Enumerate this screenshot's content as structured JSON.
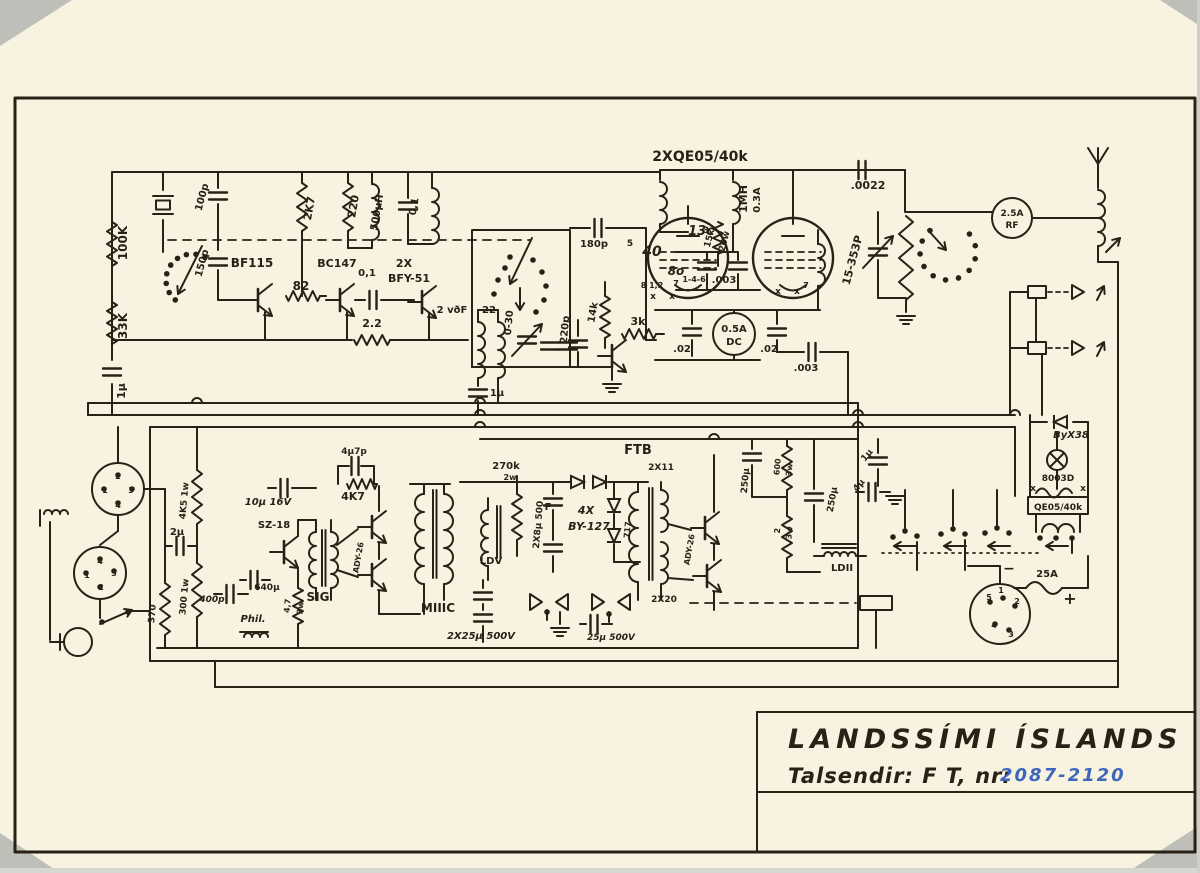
{
  "title_block": {
    "organization": "LANDSSÍMI ÍSLANDS",
    "device_label": "Talsendir: F T, nr:",
    "serial_numbers": "2087-2120"
  },
  "colors": {
    "paper": "#f8f3e1",
    "ink": "#2a2116",
    "blue_ink": "#3f66bd",
    "scan_gray": "#bfbfba"
  },
  "labels": [
    {
      "id": "r-100k",
      "t": "100K",
      "x": 127,
      "y": 243,
      "r": -90,
      "s": 12
    },
    {
      "id": "r-33k",
      "t": "33K",
      "x": 127,
      "y": 326,
      "r": -90,
      "s": 12
    },
    {
      "id": "c-1u-left",
      "t": "1μ",
      "x": 125,
      "y": 391,
      "r": -90,
      "s": 11
    },
    {
      "id": "c-100p",
      "t": "100p",
      "x": 205,
      "y": 198,
      "r": -75,
      "s": 10
    },
    {
      "id": "c-150p",
      "t": "150p",
      "x": 205,
      "y": 264,
      "r": -75,
      "s": 10
    },
    {
      "id": "q-bf115",
      "t": "BF115",
      "x": 252,
      "y": 267,
      "s": 12
    },
    {
      "id": "r-82",
      "t": "82",
      "x": 301,
      "y": 290,
      "s": 12
    },
    {
      "id": "q-bc147",
      "t": "BC147",
      "x": 337,
      "y": 267,
      "s": 11
    },
    {
      "id": "r-2k7",
      "t": "2K7",
      "x": 313,
      "y": 209,
      "r": -80,
      "s": 11
    },
    {
      "id": "r-220",
      "t": "220",
      "x": 357,
      "y": 207,
      "r": -80,
      "s": 11
    },
    {
      "id": "l-500uh",
      "t": "500μH",
      "x": 380,
      "y": 213,
      "r": -80,
      "s": 10
    },
    {
      "id": "c-01-tank",
      "t": "0,1",
      "x": 417,
      "y": 207,
      "r": -80,
      "s": 10
    },
    {
      "id": "c-01-coupling",
      "t": "0,1",
      "x": 367,
      "y": 276,
      "s": 10
    },
    {
      "id": "q-2x",
      "t": "2X",
      "x": 404,
      "y": 267,
      "s": 11
    },
    {
      "id": "q-bfy51",
      "t": "BFY-51",
      "x": 409,
      "y": 282,
      "s": 11
    },
    {
      "id": "r-22",
      "t": "2.2",
      "x": 372,
      "y": 327,
      "s": 11
    },
    {
      "id": "l-2vdf",
      "t": "2 vðF",
      "x": 452,
      "y": 313,
      "s": 10
    },
    {
      "id": "l-22b",
      "t": "22",
      "x": 489,
      "y": 313,
      "s": 10
    },
    {
      "id": "c-030",
      "t": "0-30",
      "x": 512,
      "y": 323,
      "r": -85,
      "s": 10
    },
    {
      "id": "c-180p",
      "t": "180p",
      "x": 594,
      "y": 247,
      "s": 10
    },
    {
      "id": "c-220p",
      "t": "220p",
      "x": 568,
      "y": 330,
      "r": -85,
      "s": 10
    },
    {
      "id": "r-14k",
      "t": "14k",
      "x": 596,
      "y": 313,
      "r": -80,
      "s": 10
    },
    {
      "id": "r-3k",
      "t": "3k",
      "x": 638,
      "y": 325,
      "s": 11
    },
    {
      "id": "c-1u-mid",
      "t": "1μ",
      "x": 497,
      "y": 396,
      "s": 10
    },
    {
      "id": "l-tubes",
      "t": "2XQE05/40k",
      "x": 700,
      "y": 161,
      "s": 14,
      "b": 1
    },
    {
      "id": "l-1mh",
      "t": "1MH",
      "x": 747,
      "y": 199,
      "r": -90,
      "s": 11
    },
    {
      "id": "l-03a",
      "t": "0.3A",
      "x": 760,
      "y": 200,
      "r": -90,
      "s": 10
    },
    {
      "id": "r-15k",
      "t": "15k",
      "x": 712,
      "y": 239,
      "r": -75,
      "s": 9
    },
    {
      "id": "r-20w",
      "t": "20w",
      "x": 727,
      "y": 242,
      "r": -75,
      "s": 9
    },
    {
      "id": "b-13c",
      "t": "13c",
      "x": 701,
      "y": 235,
      "s": 13,
      "c": "blue",
      "i": 1
    },
    {
      "id": "b-40",
      "t": "40",
      "x": 652,
      "y": 256,
      "s": 14,
      "c": "blue",
      "i": 1
    },
    {
      "id": "b-8o",
      "t": "8o",
      "x": 676,
      "y": 275,
      "s": 12,
      "c": "blue",
      "i": 1
    },
    {
      "id": "pin-5",
      "t": "5",
      "x": 630,
      "y": 246,
      "s": 9
    },
    {
      "id": "pin-3",
      "t": "3",
      "x": 706,
      "y": 233,
      "s": 9
    },
    {
      "id": "pin-812",
      "t": "8 1,2",
      "x": 652,
      "y": 288,
      "s": 8
    },
    {
      "id": "pin-7",
      "t": "7",
      "x": 676,
      "y": 286,
      "s": 8
    },
    {
      "id": "pin-x1",
      "t": "x",
      "x": 653,
      "y": 299,
      "s": 9
    },
    {
      "id": "pin-x2",
      "t": "x",
      "x": 672,
      "y": 299,
      "s": 9
    },
    {
      "id": "l-146",
      "t": "1-4-6",
      "x": 694,
      "y": 282,
      "s": 8
    },
    {
      "id": "c-003a",
      "t": ".003",
      "x": 724,
      "y": 283,
      "s": 10
    },
    {
      "id": "pin-x3",
      "t": "x",
      "x": 778,
      "y": 294,
      "s": 9
    },
    {
      "id": "pin-x4",
      "t": "x",
      "x": 797,
      "y": 294,
      "s": 9
    },
    {
      "id": "pin-7b",
      "t": "7",
      "x": 806,
      "y": 288,
      "s": 8
    },
    {
      "id": "c-02a",
      "t": ".02",
      "x": 682,
      "y": 352,
      "s": 10
    },
    {
      "id": "m-05a",
      "t": "0.5A",
      "x": 734,
      "y": 332,
      "s": 10,
      "b": 1
    },
    {
      "id": "m-dc",
      "t": "DC",
      "x": 734,
      "y": 345,
      "s": 10,
      "b": 1
    },
    {
      "id": "c-02b",
      "t": ".02",
      "x": 769,
      "y": 352,
      "s": 10
    },
    {
      "id": "c-003b",
      "t": ".003",
      "x": 806,
      "y": 371,
      "s": 10
    },
    {
      "id": "c-0022",
      "t": ".0022",
      "x": 868,
      "y": 189,
      "s": 11
    },
    {
      "id": "c-15353",
      "t": "15-353P",
      "x": 856,
      "y": 261,
      "r": -75,
      "s": 11
    },
    {
      "id": "m-25a",
      "t": "2.5A",
      "x": 1012,
      "y": 216,
      "s": 9,
      "b": 1
    },
    {
      "id": "m-rf",
      "t": "RF",
      "x": 1012,
      "y": 228,
      "s": 9,
      "b": 1
    },
    {
      "id": "d-byx38",
      "t": "ByX38",
      "x": 1071,
      "y": 438,
      "s": 10,
      "i": 1
    },
    {
      "id": "l-8003d",
      "t": "8003D",
      "x": 1058,
      "y": 481,
      "s": 9
    },
    {
      "id": "l-qe05",
      "t": "QE05/40k",
      "x": 1058,
      "y": 510,
      "s": 9
    },
    {
      "id": "x-a",
      "t": "x",
      "x": 1033,
      "y": 491,
      "s": 9
    },
    {
      "id": "x-b",
      "t": "x",
      "x": 1083,
      "y": 491,
      "s": 9
    },
    {
      "id": "s1-2",
      "t": "2",
      "x": 118,
      "y": 479,
      "s": 8
    },
    {
      "id": "s1-1",
      "t": "1",
      "x": 105,
      "y": 493,
      "s": 8
    },
    {
      "id": "s1-3",
      "t": "3",
      "x": 131,
      "y": 493,
      "s": 8
    },
    {
      "id": "s1-4",
      "t": "4",
      "x": 118,
      "y": 508,
      "s": 8
    },
    {
      "id": "s2-4",
      "t": "4",
      "x": 100,
      "y": 564,
      "s": 8
    },
    {
      "id": "s2-1",
      "t": "1",
      "x": 87,
      "y": 578,
      "s": 8
    },
    {
      "id": "s2-3",
      "t": "3",
      "x": 114,
      "y": 576,
      "s": 8
    },
    {
      "id": "s2-2",
      "t": "2",
      "x": 101,
      "y": 590,
      "s": 8
    },
    {
      "id": "c-2u",
      "t": "2μ",
      "x": 177,
      "y": 535,
      "s": 10
    },
    {
      "id": "r-4k5",
      "t": "4K5 1w",
      "x": 187,
      "y": 501,
      "r": -85,
      "s": 9
    },
    {
      "id": "r-300",
      "t": "300 1w",
      "x": 187,
      "y": 597,
      "r": -85,
      "s": 9
    },
    {
      "id": "r-370",
      "t": "370",
      "x": 155,
      "y": 614,
      "r": -85,
      "s": 9
    },
    {
      "id": "c-400p",
      "t": "400p",
      "x": 212,
      "y": 602,
      "s": 9,
      "i": 1
    },
    {
      "id": "c-640u",
      "t": "640μ",
      "x": 267,
      "y": 590,
      "s": 9
    },
    {
      "id": "l-phil",
      "t": "Phil.",
      "x": 253,
      "y": 622,
      "s": 10,
      "i": 1,
      "b": 1
    },
    {
      "id": "q-sz18",
      "t": "SZ-18",
      "x": 274,
      "y": 528,
      "s": 10
    },
    {
      "id": "l-sig",
      "t": "SIG",
      "x": 318,
      "y": 601,
      "s": 12,
      "b": 1
    },
    {
      "id": "c-10u",
      "t": "10μ 16V",
      "x": 268,
      "y": 505,
      "s": 10,
      "i": 1
    },
    {
      "id": "r-47",
      "t": "4,7",
      "x": 290,
      "y": 606,
      "r": -85,
      "s": 8
    },
    {
      "id": "r-3wa",
      "t": "3w",
      "x": 303,
      "y": 608,
      "r": -85,
      "s": 8
    },
    {
      "id": "c-4u7",
      "t": "4μ7p",
      "x": 354,
      "y": 454,
      "s": 9
    },
    {
      "id": "r-4k7",
      "t": "4K7",
      "x": 353,
      "y": 500,
      "s": 11
    },
    {
      "id": "q-ady26a",
      "t": "ADY-26",
      "x": 361,
      "y": 558,
      "r": -80,
      "s": 8
    },
    {
      "id": "l-m3c",
      "t": "MIIIC",
      "x": 438,
      "y": 612,
      "s": 12,
      "b": 1
    },
    {
      "id": "r-270k",
      "t": "270k",
      "x": 506,
      "y": 469,
      "s": 10
    },
    {
      "id": "r-2w",
      "t": "2w",
      "x": 510,
      "y": 480,
      "s": 8
    },
    {
      "id": "l-ldv",
      "t": "LDV",
      "x": 491,
      "y": 564,
      "s": 10,
      "b": 1
    },
    {
      "id": "c-2x8u",
      "t": "2X8μ 500",
      "x": 541,
      "y": 525,
      "r": -85,
      "s": 9
    },
    {
      "id": "b-f",
      "t": "F",
      "x": 548,
      "y": 510,
      "s": 10,
      "c": "blue",
      "b": 1
    },
    {
      "id": "d-4x",
      "t": "4X",
      "x": 586,
      "y": 514,
      "s": 11,
      "i": 1
    },
    {
      "id": "d-by127",
      "t": "BY-127",
      "x": 589,
      "y": 530,
      "s": 11,
      "i": 1
    },
    {
      "id": "l-ftb",
      "t": "FTB",
      "x": 638,
      "y": 454,
      "s": 13,
      "b": 1
    },
    {
      "id": "l-2x11",
      "t": "2X11",
      "x": 661,
      "y": 470,
      "s": 9
    },
    {
      "id": "l-717",
      "t": "717",
      "x": 630,
      "y": 530,
      "r": -85,
      "s": 8
    },
    {
      "id": "q-ady26b",
      "t": "ADY-26",
      "x": 692,
      "y": 550,
      "r": -80,
      "s": 8
    },
    {
      "id": "l-2x20",
      "t": "2X20",
      "x": 664,
      "y": 602,
      "s": 9
    },
    {
      "id": "c-2x25u",
      "t": "2X25μ 500V",
      "x": 481,
      "y": 639,
      "s": 10,
      "i": 1
    },
    {
      "id": "c-25u",
      "t": "25μ 500V",
      "x": 611,
      "y": 640,
      "s": 9,
      "i": 1
    },
    {
      "id": "c-250ua",
      "t": "250μ",
      "x": 748,
      "y": 481,
      "r": -85,
      "s": 9
    },
    {
      "id": "r-600",
      "t": "600",
      "x": 780,
      "y": 467,
      "r": -85,
      "s": 8
    },
    {
      "id": "r-3wb",
      "t": "3w",
      "x": 792,
      "y": 470,
      "r": -85,
      "s": 8
    },
    {
      "id": "c-250ub",
      "t": "250μ",
      "x": 835,
      "y": 500,
      "r": -80,
      "s": 9
    },
    {
      "id": "r-2ohm",
      "t": "2",
      "x": 780,
      "y": 531,
      "r": -85,
      "s": 8
    },
    {
      "id": "r-3wc",
      "t": "3w",
      "x": 792,
      "y": 533,
      "r": -85,
      "s": 8
    },
    {
      "id": "l-ldii",
      "t": "LDII",
      "x": 842,
      "y": 571,
      "s": 10
    },
    {
      "id": "c-1uc",
      "t": "1μ",
      "x": 869,
      "y": 457,
      "r": -50,
      "s": 9
    },
    {
      "id": "c-4u",
      "t": "4μ",
      "x": 861,
      "y": 487,
      "r": -50,
      "s": 9
    },
    {
      "id": "f-25a",
      "t": "25A",
      "x": 1047,
      "y": 577,
      "s": 10
    },
    {
      "id": "sym-minus",
      "t": "−",
      "x": 1009,
      "y": 573,
      "s": 14
    },
    {
      "id": "sym-plus",
      "t": "+",
      "x": 1070,
      "y": 604,
      "s": 16
    },
    {
      "id": "sr-5",
      "t": "5",
      "x": 989,
      "y": 600,
      "s": 8
    },
    {
      "id": "sr-1",
      "t": "1",
      "x": 1001,
      "y": 593,
      "s": 8
    },
    {
      "id": "sr-2",
      "t": "2",
      "x": 1017,
      "y": 604,
      "s": 8
    },
    {
      "id": "sr-4",
      "t": "4",
      "x": 994,
      "y": 628,
      "s": 8
    },
    {
      "id": "sr-3",
      "t": "3",
      "x": 1011,
      "y": 637,
      "s": 8
    }
  ]
}
